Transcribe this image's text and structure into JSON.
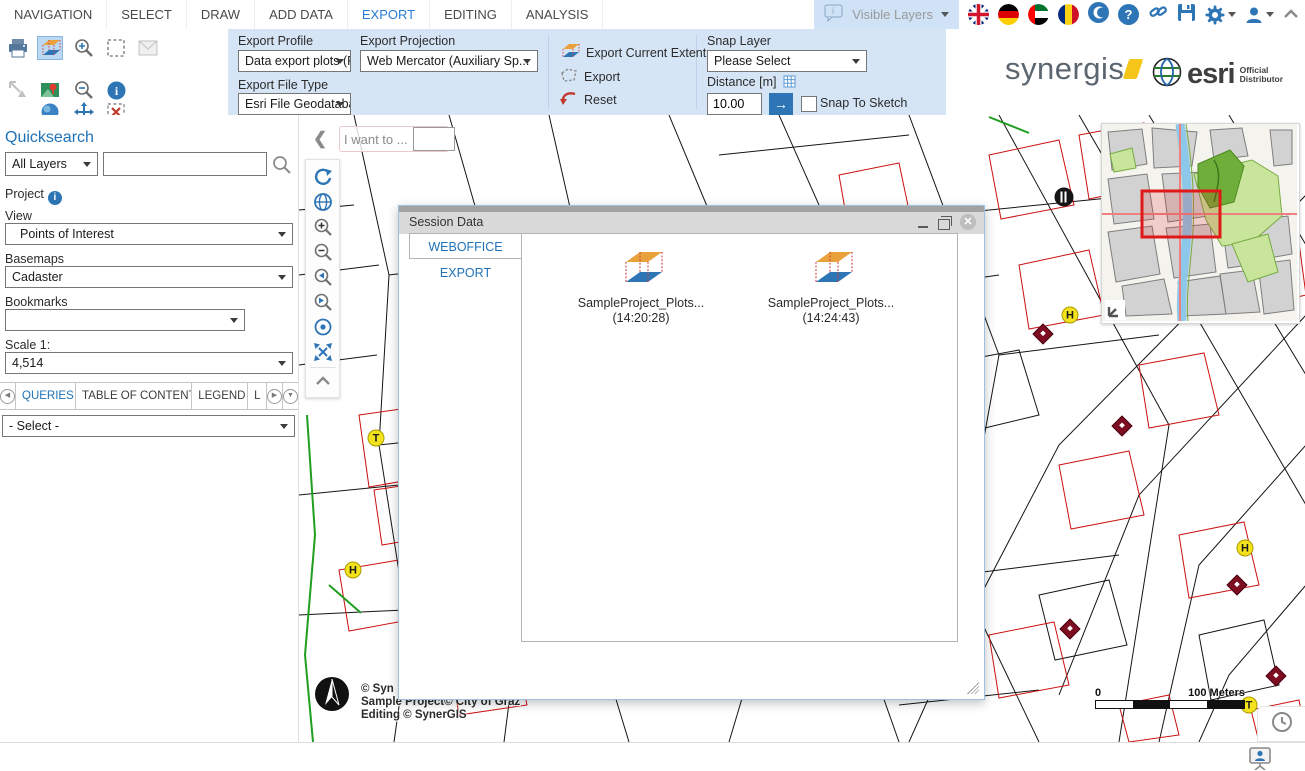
{
  "menu": {
    "items": [
      "NAVIGATION",
      "SELECT",
      "DRAW",
      "ADD DATA",
      "EXPORT",
      "EDITING",
      "ANALYSIS"
    ],
    "active": "EXPORT"
  },
  "topbar_right": {
    "visible_layers_label": "Visible Layers",
    "icons": [
      "comment-info-icon",
      "flag-uk-icon",
      "flag-germany-icon",
      "flag-uae-icon",
      "flag-romania-icon",
      "crescent-icon",
      "help-icon",
      "link-icon",
      "save-icon",
      "gear-icon",
      "user-icon",
      "collapse-chevron-icon"
    ]
  },
  "ribbon": {
    "tool_icons": [
      "print-icon",
      "share-icon",
      "export-3d-icon",
      "map-pin-icon",
      "globe-sphere-icon",
      "zoom-in-icon",
      "zoom-out-icon",
      "pan-icon",
      "select-rect-icon",
      "info-icon",
      "clear-selection-icon",
      "email-icon"
    ],
    "export_profile": {
      "label": "Export Profile",
      "value": "Data export plots (FGDB)"
    },
    "export_file_type": {
      "label": "Export File Type",
      "value": "Esri File Geodatabase"
    },
    "export_projection": {
      "label": "Export Projection",
      "value": "Web Mercator (Auxiliary Sp..."
    },
    "actions": [
      "Export Current Extent",
      "Export",
      "Reset"
    ],
    "snap_layer": {
      "label": "Snap Layer",
      "value": "Please Select"
    },
    "distance": {
      "label": "Distance [m]",
      "value": "10.00"
    },
    "snap_to_sketch_label": "Snap To Sketch",
    "logos": {
      "synergis": "synergis",
      "esri": "esri",
      "esri_sub1": "Official",
      "esri_sub2": "Distributor"
    }
  },
  "sidebar": {
    "quicksearch_title": "Quicksearch",
    "layer_select_value": "All Layers",
    "search_value": "",
    "project_label": "Project",
    "view_label": "View",
    "view_value": "Points of Interest",
    "basemaps_label": "Basemaps",
    "basemaps_value": "Cadaster",
    "bookmarks_label": "Bookmarks",
    "bookmarks_value": "",
    "scale_label": "Scale 1:",
    "scale_value": "4,514",
    "tabs": [
      "QUERIES",
      "TABLE OF CONTENT",
      "LEGEND",
      "L"
    ],
    "active_tab": "QUERIES",
    "query_select_value": "- Select -"
  },
  "map": {
    "i_want_to_label": "I want to ...",
    "toolbar_icons": [
      "refresh-icon",
      "globe-icon",
      "zoom-in-icon",
      "zoom-out-icon",
      "previous-extent-icon",
      "next-extent-icon",
      "center-point-icon",
      "full-extent-icon",
      "chevron-up-icon"
    ],
    "copyright_lines": [
      "© Syn",
      "Sample Project© City of Graz",
      "Editing © SynerGIS"
    ],
    "scalebar": {
      "zero": "0",
      "label": "100 Meters"
    },
    "markers": [
      {
        "type": "restaurant",
        "x": 765,
        "y": 82
      },
      {
        "type": "tram-stop",
        "label": "T",
        "x": 77,
        "y": 323
      },
      {
        "type": "hydrant",
        "label": "H",
        "x": 54,
        "y": 455
      },
      {
        "type": "hydrant",
        "label": "H",
        "x": 771,
        "y": 200
      },
      {
        "type": "hydrant",
        "label": "H",
        "x": 946,
        "y": 433
      },
      {
        "type": "tram-stop",
        "label": "T",
        "x": 950,
        "y": 590
      },
      {
        "type": "monument",
        "x": 744,
        "y": 219
      },
      {
        "type": "monument",
        "x": 823,
        "y": 311
      },
      {
        "type": "monument",
        "x": 938,
        "y": 470
      },
      {
        "type": "monument",
        "x": 771,
        "y": 514
      },
      {
        "type": "monument",
        "x": 977,
        "y": 561
      }
    ]
  },
  "dialog": {
    "title": "Session Data",
    "tab_label": "WEBOFFICE EXPORT",
    "items": [
      {
        "name": "SampleProject_Plots...",
        "time": "(14:20:28)"
      },
      {
        "name": "SampleProject_Plots...",
        "time": "(14:24:43)"
      }
    ]
  },
  "colors": {
    "accent_blue": "#2e75b6",
    "ribbon_bg": "#d6e5f6",
    "active_tab_text": "#1f72b8",
    "marker_yellow": "#f4e31c",
    "marker_dark_red": "#7d0d20",
    "extent_rect_red": "#e01818",
    "synergis_yellow": "#f5c518"
  }
}
